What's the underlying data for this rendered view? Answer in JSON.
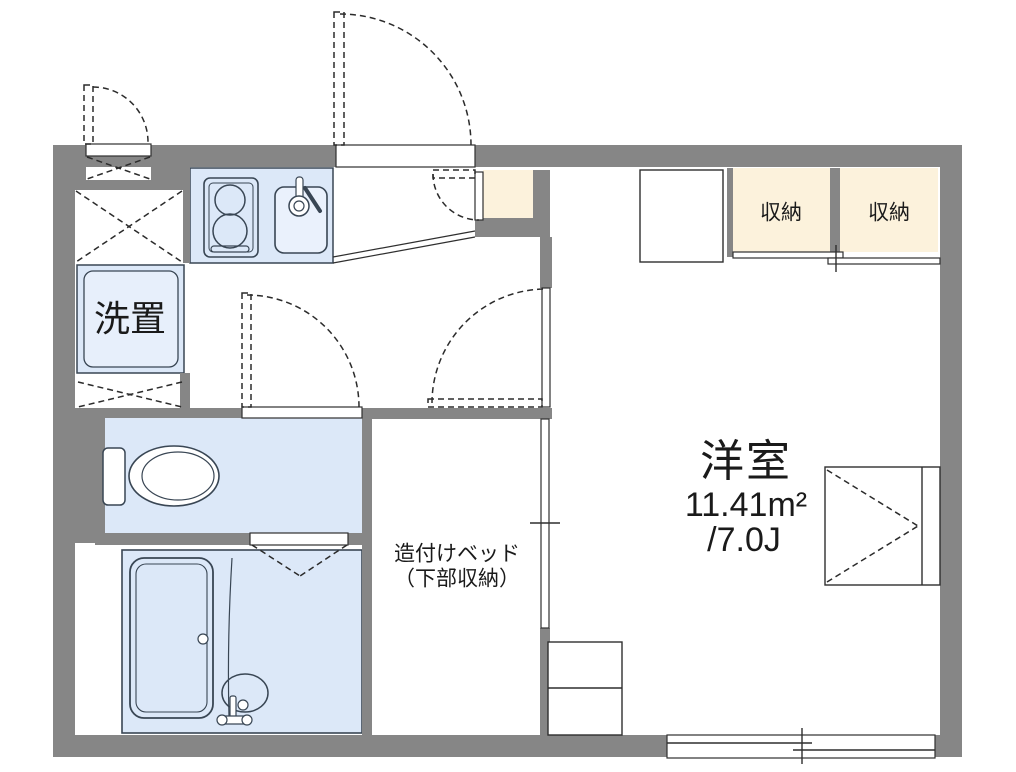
{
  "floorplan": {
    "rooms": {
      "main_room": {
        "name": "洋室",
        "area_m2": "11.41m²",
        "area_tatami": "/7.0J"
      },
      "storage_left": {
        "name": "収納"
      },
      "storage_right": {
        "name": "収納"
      },
      "washer_place": {
        "name": "洗置"
      },
      "built_in_bed": {
        "line1": "造付けベッド",
        "line2": "（下部収納）"
      }
    },
    "colors": {
      "wall": "#868686",
      "water_area_fill": "#dce8f8",
      "water_area_fill_light": "#e7effb",
      "storage_fill": "#fcf2dc",
      "line": "#2f2f2f",
      "fixture_line": "#394654",
      "background": "#ffffff",
      "text": "#1a1a1a"
    },
    "icons": [
      "entry-door-swing-icon",
      "service-door-swing-icon",
      "kitchen-door-swing-icon",
      "toilet-door-swing-icon",
      "room-door-swing-icon",
      "folding-door-icon",
      "sliding-door-icon",
      "closet-sliding-track-icon",
      "sliding-window-icon",
      "casement-window-icon",
      "pipe-space-cross-icon",
      "gas-stove-icon",
      "kitchen-sink-icon",
      "faucet-icon",
      "toilet-icon",
      "bathtub-icon",
      "shower-basin-icon",
      "refrigerator-space",
      "counter-step-line"
    ]
  }
}
